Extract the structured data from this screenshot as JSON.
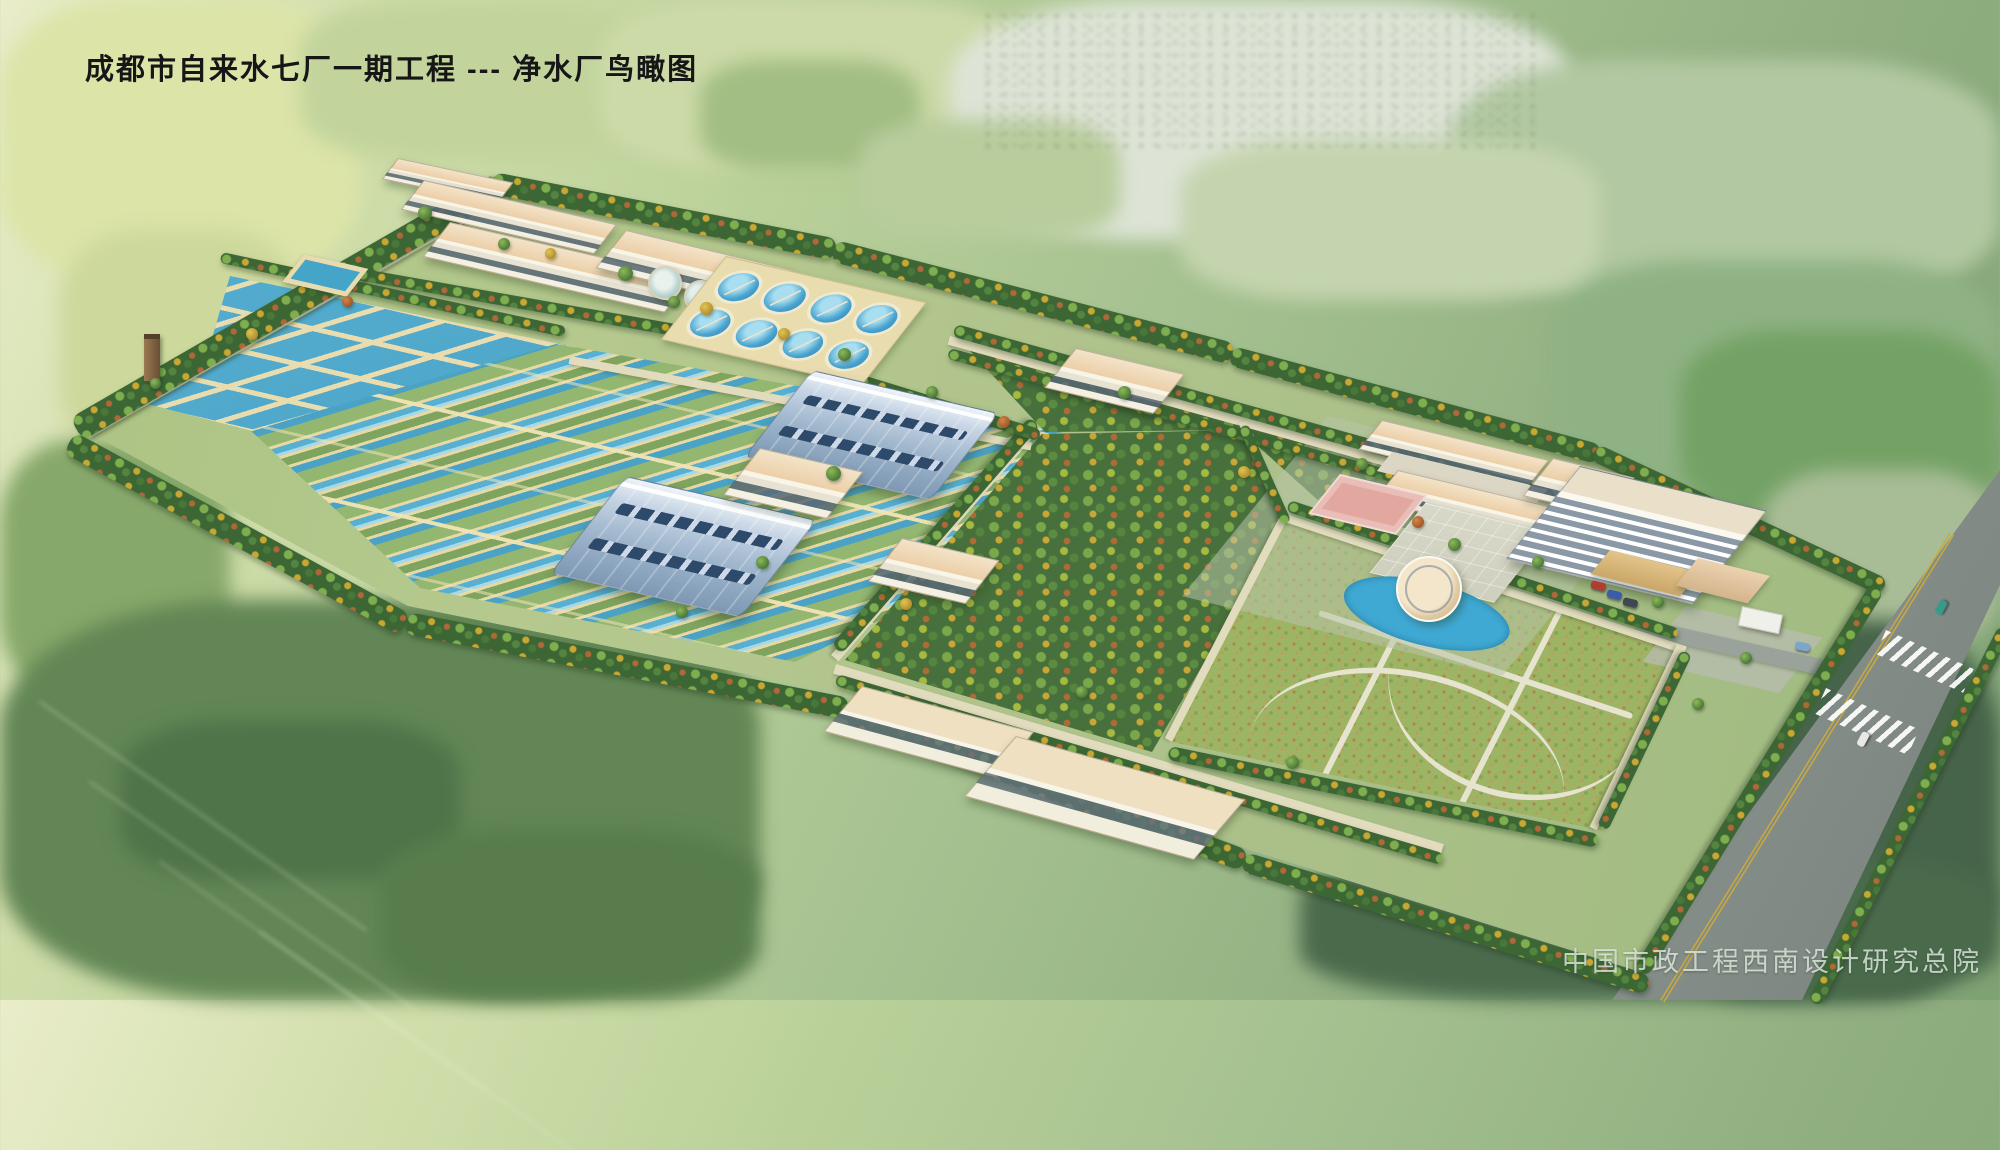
{
  "meta": {
    "title": "成都市自来水七厂一期工程 --- 净水厂鸟瞰图",
    "credit": "中国市政工程西南设计研究总院"
  },
  "scene": {
    "type": "architectural-aerial-rendering",
    "subject": "water purification plant bird's-eye view",
    "clarifier_count": 8,
    "small_round_tank_count": 2,
    "cars": {
      "road": [
        {
          "color": "#3a9a8a"
        },
        {
          "color": "#e8e8e8"
        },
        {
          "color": "#7aa8cc"
        }
      ],
      "parking": [
        {
          "color": "#b23c32"
        },
        {
          "color": "#3c5ca8"
        },
        {
          "color": "#3f4750"
        }
      ]
    },
    "palette": {
      "water_blue": "#4aa4d0",
      "basin_teal": "#57b0d2",
      "walkway_tan": "#e8dcae",
      "roof_tan": "#eccfa8",
      "arch_roof_blue": "#9fb6cc",
      "tree_green": "#4a7838",
      "tree_yellow": "#c9a832",
      "tree_orange": "#b06838",
      "field_light": "#d2dfac",
      "field_dark": "#46644a",
      "road_gray": "#868f89",
      "court_pink": "#e2a8a0",
      "title_color": "#161616",
      "credit_color": "#dfe9df"
    }
  }
}
